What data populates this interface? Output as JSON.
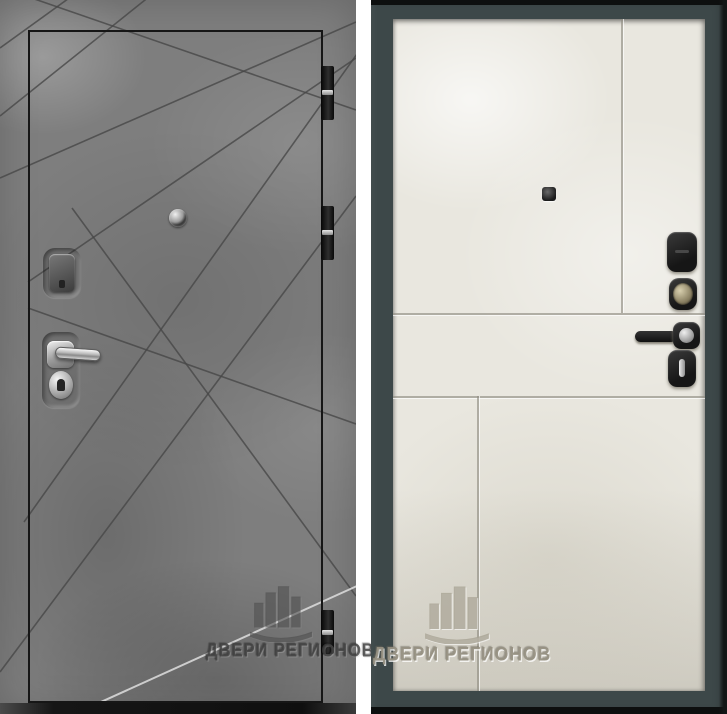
{
  "watermark": {
    "text": "ДВЕРИ РЕГИОНОВ",
    "logo_icon": "city-buildings-emblem"
  },
  "views": {
    "exterior": {
      "finish_icons": [
        "concrete-texture",
        "diagonal-grooves"
      ],
      "hardware_icons": [
        "peephole",
        "lock-escutcheon",
        "chrome-lever-handle",
        "lock-cylinder"
      ],
      "hinge_icons": [
        "hinge",
        "hinge",
        "hinge"
      ]
    },
    "interior": {
      "finish_icons": [
        "ivory-panel",
        "panel-grooves"
      ],
      "hardware_icons": [
        "peephole",
        "lock-escutcheon",
        "cylinder-knob",
        "black-lever-handle",
        "thumb-turn"
      ]
    }
  },
  "colors": {
    "exterior_concrete": "#7e7e7e",
    "groove_dark": "#474747",
    "groove_light": "#d8d8d8",
    "leaf_outline": "#161616",
    "interior_panel": "#e9e7df",
    "interior_frame": "#3d4849",
    "hardware_black": "#1f1f1f",
    "chrome": "#d9d9d9",
    "gap_white": "#ffffff"
  }
}
